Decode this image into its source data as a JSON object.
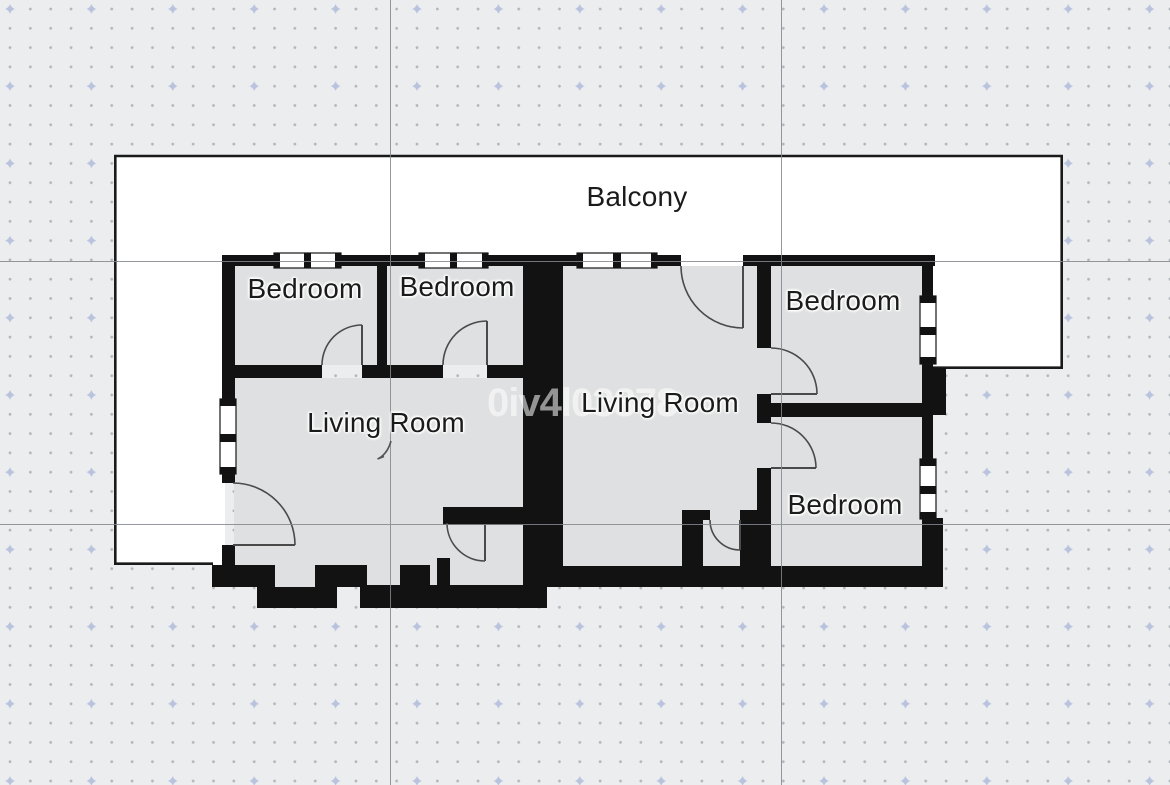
{
  "canvas": {
    "background": "#ecedef",
    "grid": {
      "dot_color": "#b2b7bd",
      "marker_color": "#b9c3de",
      "major_line_color": "#83878c"
    }
  },
  "floor_plan": {
    "labels": [
      {
        "id": "balcony",
        "text": "Balcony"
      },
      {
        "id": "bedroom-1",
        "text": "Bedroom"
      },
      {
        "id": "bedroom-2",
        "text": "Bedroom"
      },
      {
        "id": "living-room-1",
        "text": "Living Room"
      },
      {
        "id": "living-room-2",
        "text": "Living Room"
      },
      {
        "id": "bedroom-3",
        "text": "Bedroom"
      },
      {
        "id": "bedroom-4",
        "text": "Bedroom"
      }
    ],
    "watermark": "0iv4l03878",
    "colors": {
      "wall": "#121212",
      "room_fill": "#dfe0e1",
      "balcony_fill": "#ffffff",
      "balcony_outline": "#1a1a1a",
      "label_text": "#1b1b1b",
      "door_arc": "#4a4a4a"
    }
  }
}
